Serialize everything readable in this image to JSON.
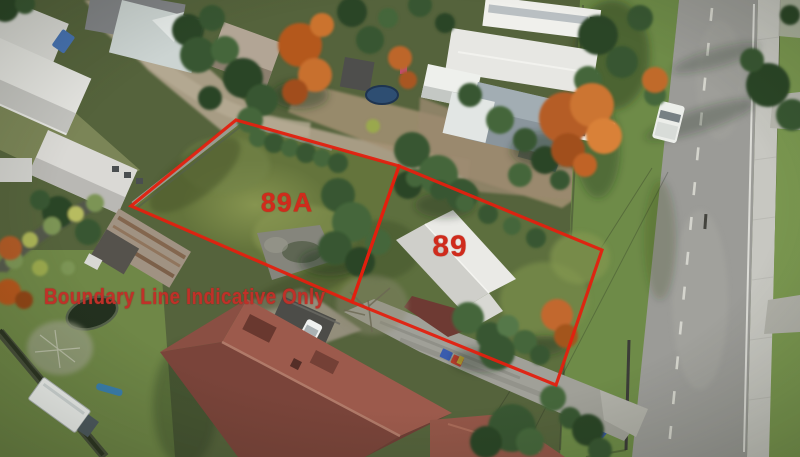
{
  "overlay": {
    "rear_lot_label": "89A",
    "front_lot_label": "89",
    "disclaimer_text": "Boundary Line Indicative Only",
    "line_color": "#e3200f",
    "label_color": "#d02b1c",
    "disclaimer_color": "#bf3129"
  },
  "scene": {
    "features": [
      "rear lawn lot 89A",
      "house with white roof on lot 89",
      "red villa roof bottom left",
      "rusty shed",
      "shared gravel driveway",
      "street with centre line right side",
      "concrete footpath",
      "grass berm",
      "autumn orange trees",
      "parked white ute on berm",
      "white truck bottom left",
      "trampoline",
      "wheelie bins at kerb"
    ],
    "palette": {
      "lawn_green": "#64743c",
      "tree_green": "#33522c",
      "autumn_orange": "#c2672e",
      "road_gray": "#9b9b97",
      "footpath_concrete": "#c7c7c1",
      "villa_roof_red": "#8d5044",
      "white_roof": "#e2e2df",
      "rusty_shed_roof": "#a09282"
    }
  }
}
